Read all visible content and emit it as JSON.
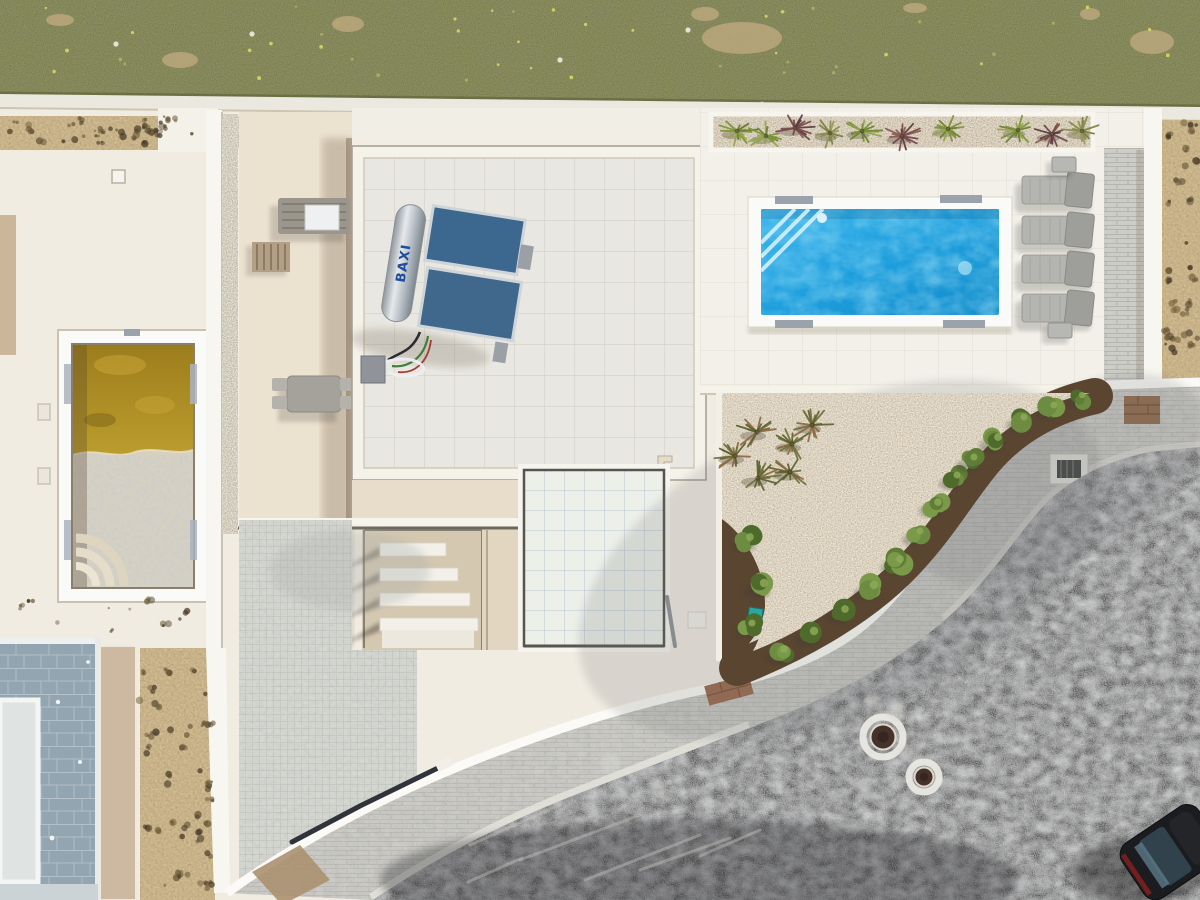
{
  "labels": {
    "solar_brand": "BAXI"
  },
  "colors": {
    "grass": "#72753f",
    "boundary_wall": "#ebe9df",
    "wall": "#f8f6f0",
    "paving": "#f1ece2",
    "terrace": "#ece2d0",
    "sand": "#d7bf94",
    "pool_frame": "#fafaf8",
    "pool_water": "#1e9fdd",
    "murky_water": "#ac8a20",
    "concrete": "#d9d2c4",
    "slate": "#92a5b0",
    "roof_tile": "#e9e7e1",
    "parapet": "#f5f2ea",
    "deck": "#f2f0e9",
    "planter_soil": "#c6b28f",
    "gravel": "#d8c7a9",
    "mulch": "#5a4531",
    "curb": "#d7d6d0",
    "asphalt": "#46474a",
    "mosaic": "#d8d9d3",
    "lounger": "#b4b4b0",
    "solar_panel": "#3c688f",
    "car_body": "#1b1c1f",
    "irrigation_box": "#2aa8a0"
  },
  "palettes": {
    "shrub_greens": [
      "#5f7d37",
      "#6d8c41",
      "#4f6b2c",
      "#7a9a4a"
    ],
    "plant_green": [
      "#7d9338",
      "#92a845",
      "#6a8030"
    ],
    "plant_purple": [
      "#6e4550",
      "#7b4a45",
      "#5c3a44",
      "#8a5a50"
    ],
    "plant_olive": [
      "#8a8f4e",
      "#7a7f42",
      "#999a58"
    ],
    "plant_garden": [
      "#6f703a",
      "#8a6a42",
      "#5d6030"
    ]
  },
  "counts": {
    "sun_loungers": 4,
    "lounger_side_tables": 2,
    "planter_plants": 10,
    "garden_plants": 6,
    "mulch_shrubs": 16,
    "stair_treads": 4,
    "manholes": 2,
    "pool_grates": 4,
    "parked_cars": 1
  },
  "objects": {
    "sun_loungers": [
      [
        1022,
        176
      ],
      [
        1022,
        216
      ],
      [
        1022,
        255
      ],
      [
        1022,
        294
      ]
    ],
    "lounger_tables": [
      [
        1052,
        157
      ],
      [
        1048,
        323
      ]
    ],
    "planter_plants": [
      [
        737,
        131,
        "green"
      ],
      [
        766,
        136,
        "green"
      ],
      [
        795,
        128,
        "purple"
      ],
      [
        830,
        133,
        "olive"
      ],
      [
        862,
        131,
        "green"
      ],
      [
        902,
        136,
        "purple"
      ],
      [
        948,
        129,
        "green"
      ],
      [
        1018,
        130,
        "green"
      ],
      [
        1052,
        134,
        "purple"
      ],
      [
        1082,
        131,
        "olive"
      ]
    ],
    "garden_plants": [
      [
        757,
        432
      ],
      [
        792,
        444
      ],
      [
        790,
        472
      ],
      [
        758,
        478
      ],
      [
        735,
        456
      ],
      [
        812,
        425
      ]
    ],
    "mulch_shrubs": [
      [
        748,
        540,
        11
      ],
      [
        762,
        586,
        12
      ],
      [
        750,
        626,
        10
      ],
      [
        782,
        652,
        11
      ],
      [
        812,
        634,
        12
      ],
      [
        843,
        612,
        11
      ],
      [
        872,
        588,
        12
      ],
      [
        898,
        562,
        11
      ],
      [
        918,
        534,
        10
      ],
      [
        936,
        505,
        11
      ],
      [
        955,
        478,
        10
      ],
      [
        972,
        460,
        10
      ],
      [
        996,
        440,
        11
      ],
      [
        1022,
        420,
        10
      ],
      [
        1052,
        408,
        10
      ],
      [
        1080,
        398,
        9
      ]
    ],
    "stair_treads": [
      [
        543,
        66
      ],
      [
        568,
        78
      ],
      [
        593,
        90
      ],
      [
        618,
        98
      ]
    ],
    "manholes": [
      [
        883,
        737,
        20,
        12.5
      ],
      [
        924,
        777,
        15,
        9.5
      ]
    ],
    "scuffs": [
      [
        470,
        845,
        560,
        805
      ],
      [
        520,
        860,
        640,
        815
      ],
      [
        585,
        880,
        700,
        835
      ],
      [
        468,
        882,
        522,
        858
      ],
      [
        640,
        870,
        730,
        838
      ],
      [
        700,
        856,
        760,
        830
      ]
    ],
    "chalk": [
      [
        610,
        762,
        10
      ],
      [
        660,
        790,
        7
      ],
      [
        896,
        712,
        9
      ],
      [
        905,
        752,
        6
      ],
      [
        872,
        700,
        7
      ]
    ],
    "grass_patches": [
      [
        348,
        24,
        16,
        8
      ],
      [
        742,
        38,
        40,
        16
      ],
      [
        705,
        14,
        14,
        7
      ],
      [
        1152,
        42,
        22,
        12
      ],
      [
        1090,
        14,
        10,
        6
      ],
      [
        915,
        8,
        12,
        5
      ],
      [
        60,
        20,
        14,
        6
      ],
      [
        180,
        60,
        18,
        8
      ]
    ],
    "white_stones": [
      [
        116,
        44
      ],
      [
        252,
        34
      ],
      [
        762,
        104
      ],
      [
        688,
        30
      ],
      [
        560,
        60
      ]
    ],
    "weed_areas": [
      {
        "x": 6,
        "y": 118,
        "w": 196,
        "h": 30,
        "n": 34,
        "seed": 3
      },
      {
        "x": 142,
        "y": 658,
        "w": 68,
        "h": 234,
        "n": 40,
        "seed": 7
      },
      {
        "x": 1164,
        "y": 118,
        "w": 32,
        "h": 258,
        "n": 30,
        "seed": 9
      },
      {
        "x": 10,
        "y": 596,
        "w": 180,
        "h": 40,
        "n": 10,
        "seed": 13
      }
    ],
    "flowers": {
      "n": 46,
      "seed": 21,
      "x": 4,
      "y": 6,
      "w": 1190,
      "h": 80
    }
  }
}
